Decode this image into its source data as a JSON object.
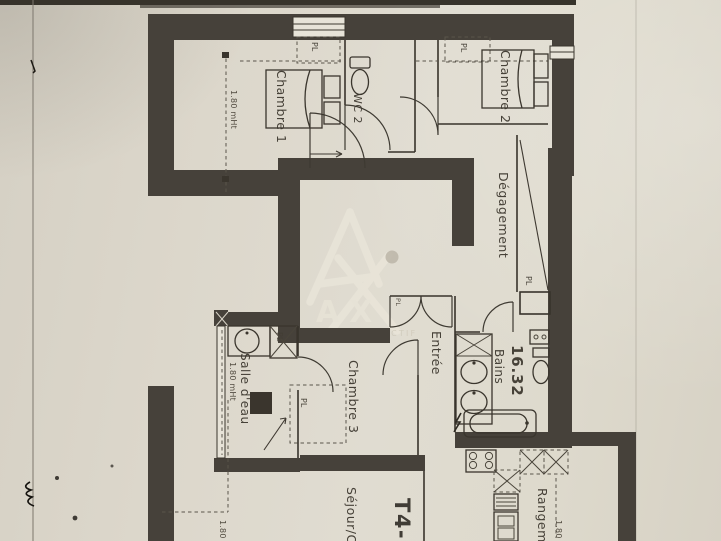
{
  "plan": {
    "unit_label": "T4-1",
    "watermark": {
      "letters": "AX",
      "tagline": "L'IMMOBILIER ACTIF"
    },
    "rooms": {
      "chambre1": {
        "label": "Chambre 1"
      },
      "wc2": {
        "label": "WC 2"
      },
      "chambre2": {
        "label": "Chambre 2"
      },
      "degagement": {
        "label": "Dégagement"
      },
      "entree": {
        "label": "Entrée"
      },
      "bains": {
        "label": "Bains",
        "area": "16.32"
      },
      "salle_deau": {
        "label": "Salle d'eau"
      },
      "chambre3": {
        "label": "Chambre 3"
      },
      "sejour": {
        "label": "Séjour/C"
      },
      "rangement": {
        "label": "Rangem"
      }
    },
    "closet_label": "PL",
    "dimensions": {
      "chambre1_height": "1.80 mHt",
      "salle_deau_height": "1.80 mHt",
      "sejour_dim": "1.80",
      "rangement_dim": "1.80"
    }
  }
}
